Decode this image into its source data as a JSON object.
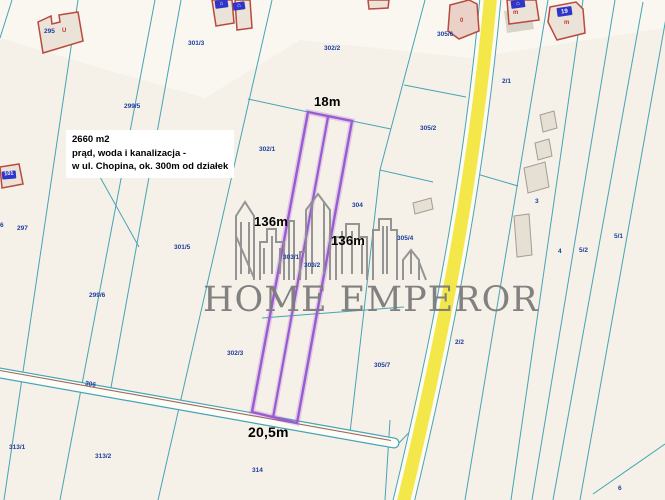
{
  "map": {
    "watermark_text": "HOME EMPEROR",
    "info_box": {
      "lines": [
        "2660 m2",
        "prąd, woda i kanalizacja -",
        "w ul. Chopina, ok. 300m od działek"
      ]
    },
    "measurements": [
      {
        "text": "18m",
        "x": 314,
        "y": 94,
        "fs": 13
      },
      {
        "text": "136m",
        "x": 254,
        "y": 214,
        "fs": 13
      },
      {
        "text": "136m",
        "x": 331,
        "y": 233,
        "fs": 13
      },
      {
        "text": "20,5m",
        "x": 248,
        "y": 424,
        "fs": 14
      }
    ],
    "parcel_labels": [
      {
        "id": "295",
        "x": 44,
        "y": 28
      },
      {
        "id": "301/3",
        "x": 188,
        "y": 40
      },
      {
        "id": "299/5",
        "x": 124,
        "y": 103
      },
      {
        "id": "302/2",
        "x": 324,
        "y": 45
      },
      {
        "id": "305/6",
        "x": 437,
        "y": 31
      },
      {
        "id": "2/1",
        "x": 502,
        "y": 78
      },
      {
        "id": "305/2",
        "x": 420,
        "y": 125
      },
      {
        "id": "297",
        "x": 17,
        "y": 225
      },
      {
        "id": "6",
        "x": 0,
        "y": 222
      },
      {
        "id": "301/5",
        "x": 174,
        "y": 244
      },
      {
        "id": "299/6",
        "x": 89,
        "y": 292
      },
      {
        "id": "302/1",
        "x": 259,
        "y": 146
      },
      {
        "id": "303/1",
        "x": 283,
        "y": 254
      },
      {
        "id": "303/2",
        "x": 304,
        "y": 262
      },
      {
        "id": "304",
        "x": 352,
        "y": 202
      },
      {
        "id": "305/4",
        "x": 397,
        "y": 235
      },
      {
        "id": "3",
        "x": 535,
        "y": 198
      },
      {
        "id": "4",
        "x": 558,
        "y": 248
      },
      {
        "id": "5/2",
        "x": 579,
        "y": 247
      },
      {
        "id": "5/1",
        "x": 614,
        "y": 233
      },
      {
        "id": "302/3",
        "x": 227,
        "y": 350
      },
      {
        "id": "305/7",
        "x": 374,
        "y": 362
      },
      {
        "id": "2/2",
        "x": 455,
        "y": 339
      },
      {
        "id": "306",
        "x": 85,
        "y": 381,
        "rot": 10
      },
      {
        "id": "313/1",
        "x": 9,
        "y": 444
      },
      {
        "id": "313/2",
        "x": 95,
        "y": 453
      },
      {
        "id": "314",
        "x": 252,
        "y": 467
      },
      {
        "id": "6",
        "x": 618,
        "y": 485
      }
    ],
    "building_labels": [
      {
        "text": "U",
        "x": 62,
        "y": 28,
        "fs": 6
      },
      {
        "text": "0",
        "x": 460,
        "y": 18,
        "fs": 6
      },
      {
        "text": "m",
        "x": 513,
        "y": 10,
        "fs": 6
      },
      {
        "text": "m",
        "x": 564,
        "y": 20,
        "fs": 6
      }
    ],
    "plates": [
      {
        "text": "⌂",
        "x": 215,
        "y": 0,
        "w": 13,
        "h": 8,
        "fs": 6,
        "rot": -8
      },
      {
        "text": "⌂",
        "x": 233,
        "y": 2,
        "w": 12,
        "h": 8,
        "fs": 6,
        "rot": -8
      },
      {
        "text": "101",
        "x": 2,
        "y": 171,
        "w": 14,
        "h": 8,
        "fs": 5.5,
        "rot": -5
      },
      {
        "text": "⌂",
        "x": 511,
        "y": 0,
        "w": 14,
        "h": 8,
        "fs": 6,
        "rot": -8
      },
      {
        "text": "19",
        "x": 557,
        "y": 7,
        "w": 15,
        "h": 9,
        "fs": 6,
        "rot": -8
      }
    ],
    "colors": {
      "background": "#f5f1e8",
      "parcel_line_teal": "#45a4b5",
      "highlight_purple": "#9c5ad2",
      "road_yellow": "#f4e74a",
      "label_blue": "#1c3e9e",
      "building_red": "#b84a3e",
      "watermark_gray": "#7c7c7c"
    }
  }
}
